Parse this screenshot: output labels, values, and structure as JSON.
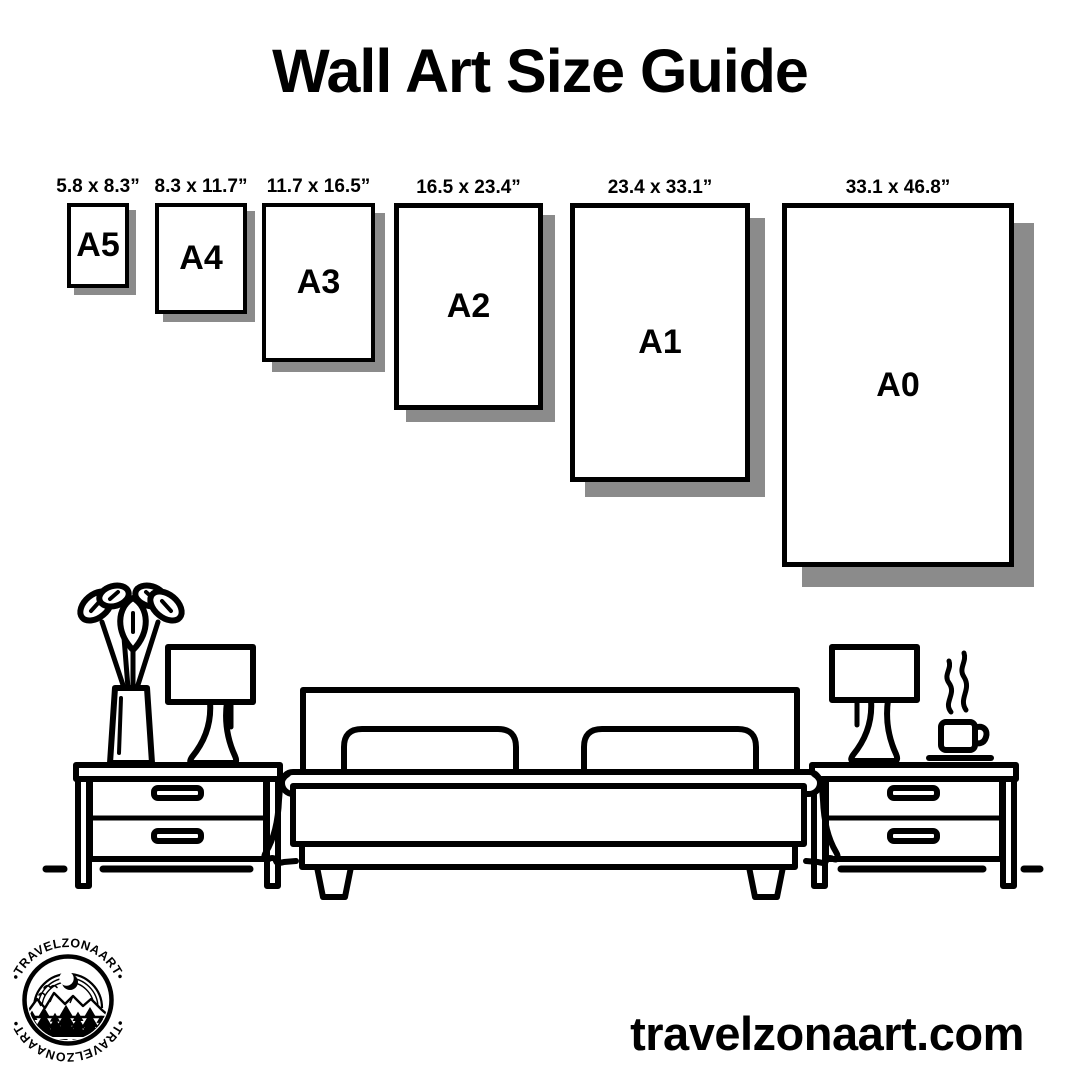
{
  "colors": {
    "ink": "#000000",
    "paper": "#ffffff",
    "shadow": "#8b8b8b"
  },
  "title": "Wall Art Size Guide",
  "frames": [
    {
      "id": "a5",
      "label": "A5",
      "dimensions": "5.8 x 8.3”"
    },
    {
      "id": "a4",
      "label": "A4",
      "dimensions": "8.3 x 11.7”"
    },
    {
      "id": "a3",
      "label": "A3",
      "dimensions": "11.7 x 16.5”"
    },
    {
      "id": "a2",
      "label": "A2",
      "dimensions": "16.5 x 23.4”"
    },
    {
      "id": "a1",
      "label": "A1",
      "dimensions": "23.4 x 33.1”"
    },
    {
      "id": "a0",
      "label": "A0",
      "dimensions": "33.1 x 46.8”"
    }
  ],
  "logo": {
    "arc_text_top": "•TRAVELZONAART•",
    "arc_text_bottom": "•TRAVELZONAART•"
  },
  "footer": {
    "website": "travelzonaart.com"
  },
  "icons": {
    "scene": [
      "plant-vase-icon",
      "table-lamp-icon",
      "nightstand-icon",
      "bed-icon",
      "pillow-icon",
      "coffee-cup-icon",
      "steam-icon",
      "floor-line"
    ],
    "logo_badge": [
      "moon-icon",
      "bird-icon",
      "mountain-icon",
      "pine-tree-icon",
      "water-lines-icon"
    ]
  }
}
